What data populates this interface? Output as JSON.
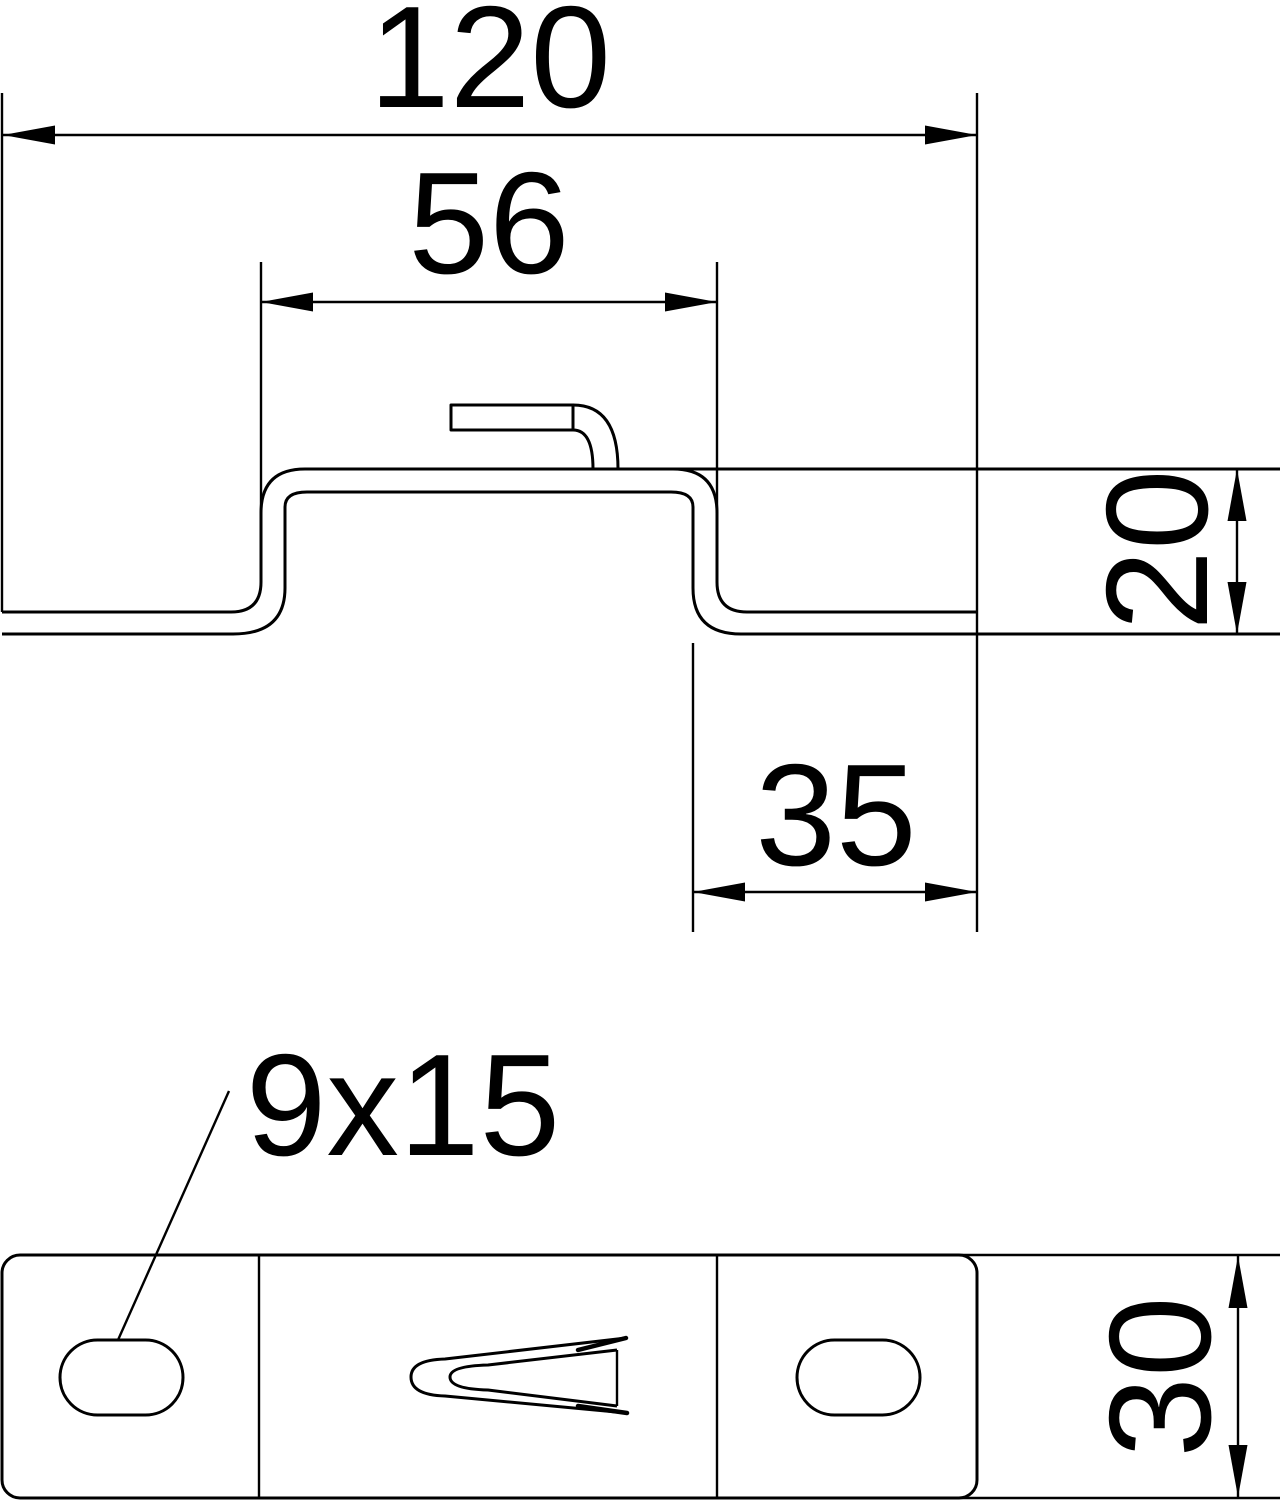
{
  "drawing": {
    "type": "technical-drawing",
    "views": {
      "section_view": "profile of hat-shaped bracket with bent-up tab",
      "plan_view": "top view of plate with two slots and punched claw"
    },
    "dimensions": {
      "overall_width": "120",
      "raised_section_width": "56",
      "profile_height": "20",
      "right_flange_width": "35",
      "slot_size": "9x15",
      "plate_depth": "30"
    },
    "colors": {
      "line": "#000000",
      "background": "#ffffff"
    }
  }
}
